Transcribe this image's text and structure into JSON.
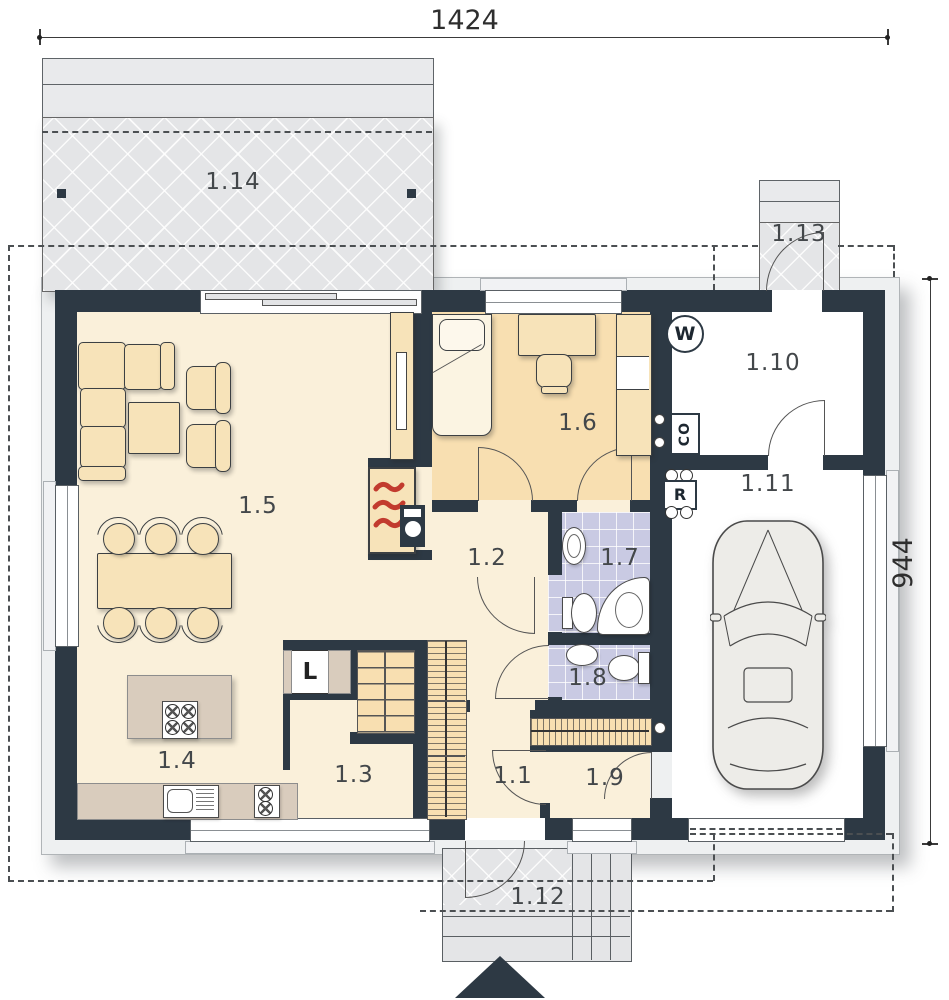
{
  "dimensions": {
    "width": "1424",
    "height": "944"
  },
  "rooms": [
    {
      "label": "1.1"
    },
    {
      "label": "1.2"
    },
    {
      "label": "1.3"
    },
    {
      "label": "1.4"
    },
    {
      "label": "1.5"
    },
    {
      "label": "1.6"
    },
    {
      "label": "1.7"
    },
    {
      "label": "1.8"
    },
    {
      "label": "1.9"
    },
    {
      "label": "1.10"
    },
    {
      "label": "1.11"
    },
    {
      "label": "1.12"
    },
    {
      "label": "1.13"
    },
    {
      "label": "1.14"
    }
  ],
  "symbols": {
    "water_heater": "W",
    "central_heating": "CO",
    "radiator": "R",
    "fridge": "L"
  },
  "colors": {
    "wall": "#2d3944",
    "floor_main": "#faf0da",
    "floor_bedroom": "#f8dfb1",
    "floor_bathroom": "#c9cae3",
    "furniture": "#f7e3b9",
    "counter": "#d9ccbd",
    "terrace": "#e4e5e7",
    "flame": "#c23b2e"
  }
}
